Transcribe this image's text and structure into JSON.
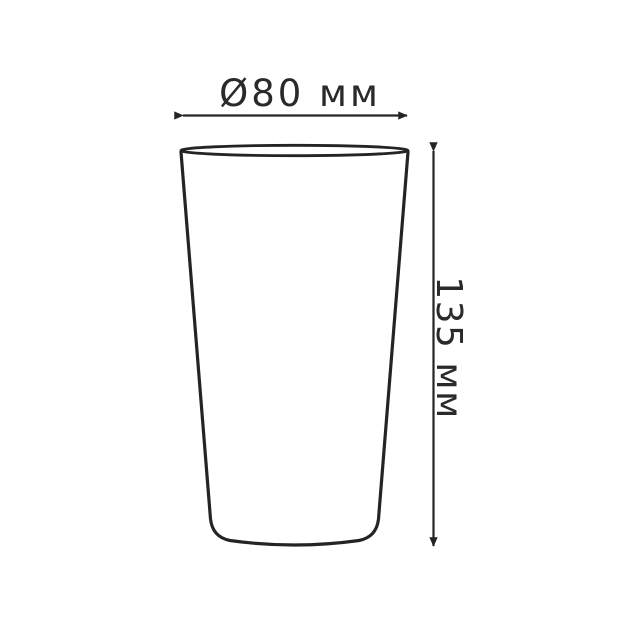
{
  "drawing": {
    "type": "technical-dimension-diagram",
    "subject": "tapered cup / glass outline (front view)",
    "background_color": "#ffffff",
    "line_color": "#242424",
    "text_color": "#2b2a29",
    "dimensions": {
      "diameter": {
        "label": "Ø80 мм",
        "symbol": "Ø",
        "value": 80,
        "unit": "мм",
        "orientation": "horizontal",
        "arrow": "double-headed"
      },
      "height": {
        "label": "135 мм",
        "value": 135,
        "unit": "мм",
        "orientation": "vertical",
        "text_rotation_deg": 90,
        "arrow": "double-headed"
      }
    }
  }
}
